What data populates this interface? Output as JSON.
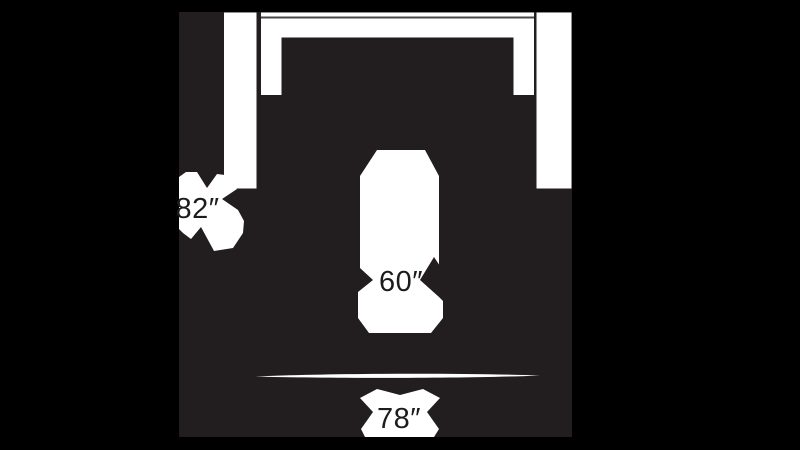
{
  "diagram": {
    "title": "product dimensions diagram",
    "colors": {
      "background": "#000000",
      "panel": "#221e20",
      "shape": "#ffffff",
      "seam": "#4a4547",
      "label": "#1e1b1c"
    },
    "dimensions": {
      "left": {
        "label": "82″"
      },
      "center": {
        "label": "60″"
      },
      "bottom": {
        "label": "78″"
      }
    }
  }
}
